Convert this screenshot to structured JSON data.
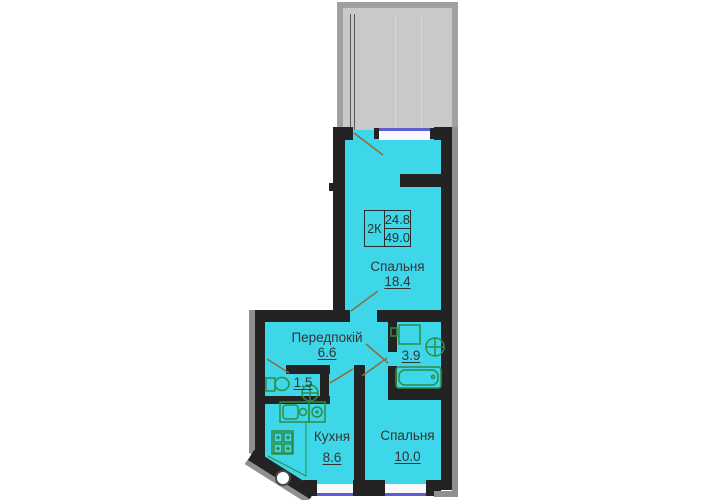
{
  "plan": {
    "unit_label": {
      "type": "2К",
      "area_top": "24.8",
      "area_bottom": "49.0"
    },
    "rooms": {
      "bedroom_top": {
        "name": "Спальня",
        "area": "18.4"
      },
      "hallway": {
        "name": "Передпокій",
        "area": "6.6"
      },
      "bathroom": {
        "area": "3.9"
      },
      "wc": {
        "area": "1.5"
      },
      "kitchen": {
        "name": "Кухня",
        "area": "8.6"
      },
      "bedroom_bottom": {
        "name": "Спальня",
        "area": "10.0"
      }
    },
    "fixtures": [
      "bathtub",
      "washing-machine",
      "round-sink",
      "toilet",
      "kitchen-sink",
      "stove",
      "cooktop-4-burner",
      "wall-vent"
    ],
    "colors": {
      "floor": "#3ed7e9",
      "wall": "#232323",
      "wall_outer": "#8f8f8f",
      "terrace_fill": "#c9c9c9",
      "terrace_border": "#a0a0a0",
      "window_glass": "#f9f9ff",
      "window_frame": "#5f5bd2",
      "fixture_green": "#2f8c46",
      "door_swing": "#8f6b3f",
      "text": "#343434"
    }
  }
}
